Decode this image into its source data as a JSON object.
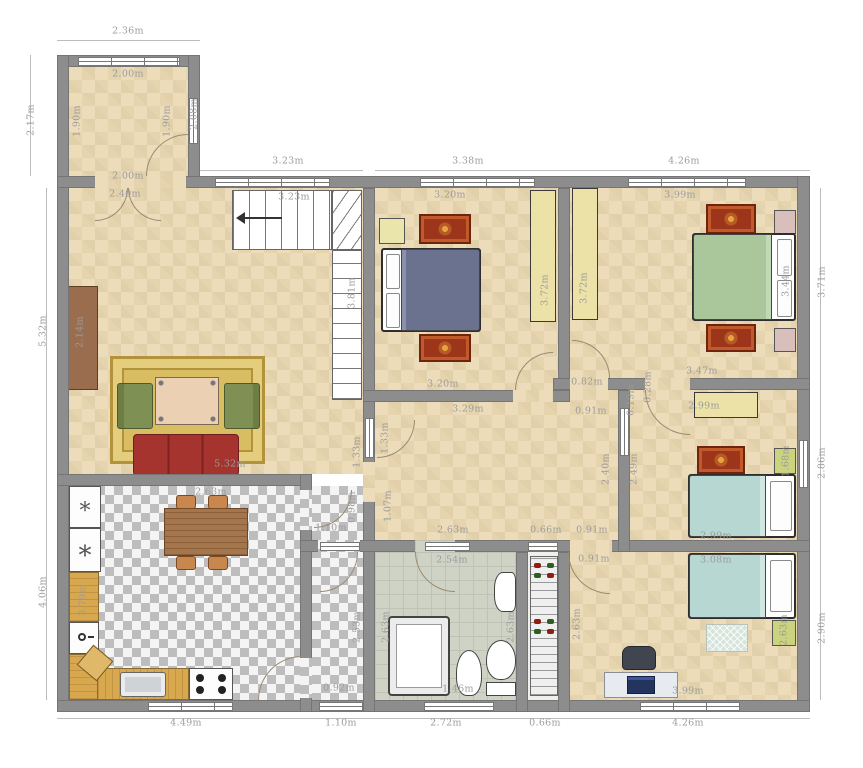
{
  "meta": {
    "type": "floor-plan",
    "units": "m"
  },
  "palette": {
    "wall": "#8d8d8d",
    "floor_beige": "#ecdcba",
    "kitchen_checker": "#bdbdbd",
    "bathroom_floor": "#cfd3c6",
    "counter_wood": "#d8a84f",
    "sofa_red": "#a6342e",
    "armchair_green": "#7f9054",
    "rug_gold": "#d9bd62",
    "rug_red": "#9c3519",
    "bed_blue": "#6b7290",
    "bed_green": "#a9c79b",
    "bed_teal": "#b7d8d2",
    "wardrobe_yellow": "#ece2a8",
    "nightstand_pink": "#d8bfbc",
    "nightstand_green": "#ccd37f",
    "dimension_text": "#9b9b9b"
  },
  "icons": {
    "appliance_symbol": "*"
  },
  "dimension_labels": [
    {
      "text": "2.36m",
      "x": 128,
      "y": 31,
      "vertical": false
    },
    {
      "text": "3.23m",
      "x": 288,
      "y": 161,
      "vertical": false
    },
    {
      "text": "3.38m",
      "x": 468,
      "y": 161,
      "vertical": false
    },
    {
      "text": "4.26m",
      "x": 684,
      "y": 161,
      "vertical": false
    },
    {
      "text": "4.49m",
      "x": 186,
      "y": 723,
      "vertical": false
    },
    {
      "text": "1.10m",
      "x": 341,
      "y": 723,
      "vertical": false
    },
    {
      "text": "2.72m",
      "x": 446,
      "y": 723,
      "vertical": false
    },
    {
      "text": "0.66m",
      "x": 545,
      "y": 723,
      "vertical": false
    },
    {
      "text": "4.26m",
      "x": 688,
      "y": 723,
      "vertical": false
    },
    {
      "text": "2.17m",
      "x": 31,
      "y": 120,
      "vertical": true
    },
    {
      "text": "5.32m",
      "x": 43,
      "y": 331,
      "vertical": true
    },
    {
      "text": "4.06m",
      "x": 43,
      "y": 592,
      "vertical": true
    },
    {
      "text": "3.71m",
      "x": 822,
      "y": 282,
      "vertical": true
    },
    {
      "text": "2.86m",
      "x": 822,
      "y": 463,
      "vertical": true
    },
    {
      "text": "2.90m",
      "x": 822,
      "y": 628,
      "vertical": true
    },
    {
      "text": "2.00m",
      "x": 128,
      "y": 74,
      "vertical": false
    },
    {
      "text": "1.90m",
      "x": 77,
      "y": 121,
      "vertical": true
    },
    {
      "text": "1.90m",
      "x": 167,
      "y": 121,
      "vertical": true
    },
    {
      "text": "2.08m",
      "x": 194,
      "y": 114,
      "vertical": true
    },
    {
      "text": "2.00m",
      "x": 128,
      "y": 176,
      "vertical": false
    },
    {
      "text": "2.40m",
      "x": 125,
      "y": 194,
      "vertical": false
    },
    {
      "text": "3.23m",
      "x": 294,
      "y": 197,
      "vertical": false
    },
    {
      "text": "3.81m",
      "x": 352,
      "y": 293,
      "vertical": true
    },
    {
      "text": "2.14m",
      "x": 80,
      "y": 332,
      "vertical": true
    },
    {
      "text": "5.32m",
      "x": 230,
      "y": 464,
      "vertical": false
    },
    {
      "text": "1.33m",
      "x": 357,
      "y": 452,
      "vertical": true
    },
    {
      "text": "1.33m",
      "x": 385,
      "y": 438,
      "vertical": true
    },
    {
      "text": "3.20m",
      "x": 450,
      "y": 195,
      "vertical": false
    },
    {
      "text": "3.72m",
      "x": 545,
      "y": 290,
      "vertical": true
    },
    {
      "text": "3.20m",
      "x": 443,
      "y": 384,
      "vertical": false
    },
    {
      "text": "3.99m",
      "x": 680,
      "y": 195,
      "vertical": false
    },
    {
      "text": "3.72m",
      "x": 584,
      "y": 288,
      "vertical": true
    },
    {
      "text": "3.44m",
      "x": 786,
      "y": 281,
      "vertical": true
    },
    {
      "text": "3.47m",
      "x": 702,
      "y": 371,
      "vertical": false
    },
    {
      "text": "0.82m",
      "x": 587,
      "y": 382,
      "vertical": false
    },
    {
      "text": "0.28m",
      "x": 648,
      "y": 387,
      "vertical": true
    },
    {
      "text": "3.29m",
      "x": 468,
      "y": 409,
      "vertical": false
    },
    {
      "text": "0.91m",
      "x": 591,
      "y": 411,
      "vertical": false
    },
    {
      "text": "1.07m",
      "x": 388,
      "y": 506,
      "vertical": true
    },
    {
      "text": "2.63m",
      "x": 453,
      "y": 530,
      "vertical": false
    },
    {
      "text": "0.66m",
      "x": 546,
      "y": 530,
      "vertical": false
    },
    {
      "text": "0.91m",
      "x": 592,
      "y": 530,
      "vertical": false
    },
    {
      "text": "2.40m",
      "x": 606,
      "y": 469,
      "vertical": true
    },
    {
      "text": "2.49m",
      "x": 634,
      "y": 469,
      "vertical": true
    },
    {
      "text": "0.19m",
      "x": 631,
      "y": 400,
      "vertical": true
    },
    {
      "text": "2.99m",
      "x": 704,
      "y": 406,
      "vertical": false
    },
    {
      "text": "1.68m",
      "x": 786,
      "y": 461,
      "vertical": true
    },
    {
      "text": "2.99m",
      "x": 716,
      "y": 536,
      "vertical": false
    },
    {
      "text": "0.91m",
      "x": 594,
      "y": 559,
      "vertical": false
    },
    {
      "text": "3.08m",
      "x": 716,
      "y": 560,
      "vertical": false
    },
    {
      "text": "2.63m",
      "x": 577,
      "y": 624,
      "vertical": true
    },
    {
      "text": "2.63m",
      "x": 784,
      "y": 630,
      "vertical": true
    },
    {
      "text": "3.99m",
      "x": 688,
      "y": 691,
      "vertical": false
    },
    {
      "text": "2.63m",
      "x": 211,
      "y": 492,
      "vertical": false
    },
    {
      "text": "3.79m",
      "x": 83,
      "y": 600,
      "vertical": true
    },
    {
      "text": "1.10m",
      "x": 331,
      "y": 528,
      "vertical": false
    },
    {
      "text": "0.98m",
      "x": 352,
      "y": 507,
      "vertical": true
    },
    {
      "text": "0.92m",
      "x": 339,
      "y": 688,
      "vertical": false
    },
    {
      "text": "2.53m",
      "x": 357,
      "y": 627,
      "vertical": true
    },
    {
      "text": "2.54m",
      "x": 452,
      "y": 560,
      "vertical": false
    },
    {
      "text": "2.63m",
      "x": 386,
      "y": 627,
      "vertical": true
    },
    {
      "text": "2.63m",
      "x": 511,
      "y": 627,
      "vertical": true
    },
    {
      "text": "1.46m",
      "x": 458,
      "y": 689,
      "vertical": false
    }
  ]
}
